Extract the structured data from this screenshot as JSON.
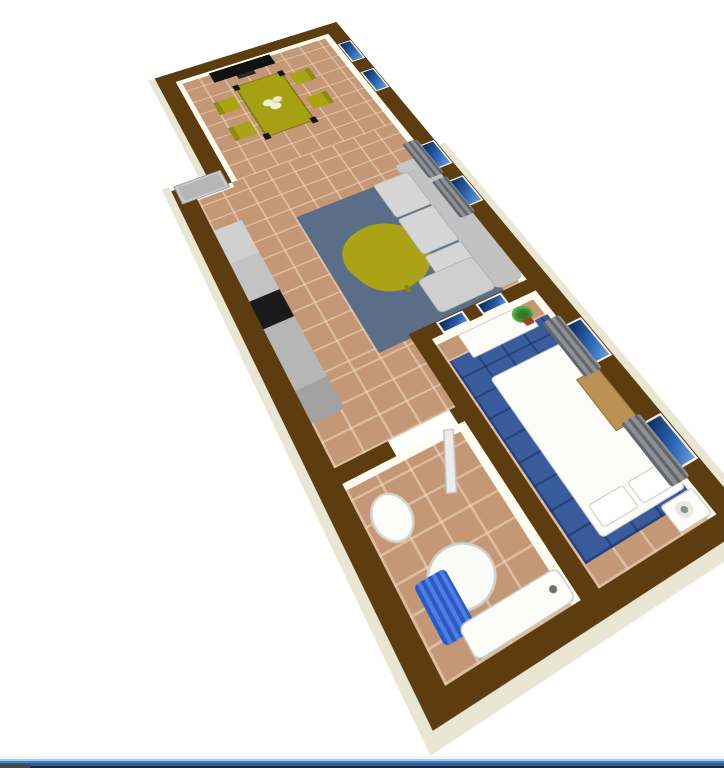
{
  "app": {
    "name": "3D floor plan aerial view",
    "view_label": "Apartment 3D render",
    "background": "#ffffff"
  },
  "colors": {
    "bg": "#ffffff",
    "wall": "#5d3c0f",
    "iface": "#fffdf2",
    "eface": "#e9e6d4",
    "floor": "#c49877",
    "rug": "#5a6e88",
    "bedrug": "#3a5c9c",
    "olive": "#aba315",
    "window_glass": "#2f6ab8",
    "curtain_gray": "#797d81",
    "sofa_gray": "#c8c8c8",
    "cooktop_black": "#1a1a1a",
    "shower_curtain_blue": "#3566d6",
    "bed_white": "#fcfcf9",
    "plant_green": "#3c9032",
    "plant_pot": "#9c4028",
    "door_gray": "#b6b6b6",
    "taskbar_blue": "#2e5f94"
  },
  "scene": {
    "rooms": [
      {
        "id": "dining-room",
        "label": "Dining room",
        "furniture": [
          "TV",
          "Dining table",
          "Chair",
          "Chair",
          "Chair",
          "Chair"
        ],
        "windows": 2
      },
      {
        "id": "living-room",
        "label": "Living room",
        "furniture": [
          "Kitchen counter",
          "Cooktop",
          "Refrigerator",
          "Area rug",
          "Coffee table",
          "Sofa",
          "Entrance door"
        ],
        "windows": 2,
        "curtains": 2
      },
      {
        "id": "bedroom",
        "label": "Bedroom",
        "furniture": [
          "Dresser",
          "Potted plant",
          "Wall picture",
          "Wall picture",
          "Blue tiled rug",
          "Double bed",
          "Pillows",
          "Wardrobe",
          "Nightstand with lamp"
        ],
        "windows": 2,
        "curtains": 2
      },
      {
        "id": "bathroom",
        "label": "Bathroom",
        "furniture": [
          "Door (open)",
          "Pedestal sink",
          "Shower with blue curtain",
          "Bathtub"
        ],
        "windows": 0
      }
    ],
    "labels": {
      "tv": "TV",
      "tv_stand": "TV stand",
      "dining_table": "Dining table",
      "place_setting": "Table place setting",
      "chair": "Dining chair",
      "entrance_door": "Entrance door",
      "kitchen_counter": "Kitchen counter",
      "cooktop": "Cooktop",
      "fridge": "Refrigerator",
      "area_rug": "Area rug",
      "coffee_table": "Coffee table",
      "sofa": "Sofa",
      "window": "Window",
      "curtain": "Curtain",
      "picture": "Wall picture",
      "dresser": "Dresser",
      "plant": "Potted plant",
      "bed_rug": "Blue tiled rug",
      "bed": "Double bed",
      "pillow": "Pillow",
      "wardrobe": "Wardrobe",
      "nightstand": "Nightstand with lamp",
      "bath_door": "Bathroom door (open)",
      "sink": "Pedestal sink",
      "shower": "Shower",
      "shower_curtain": "Shower curtain",
      "bathtub": "Bathtub",
      "taskbar": "Window edge bar"
    }
  }
}
